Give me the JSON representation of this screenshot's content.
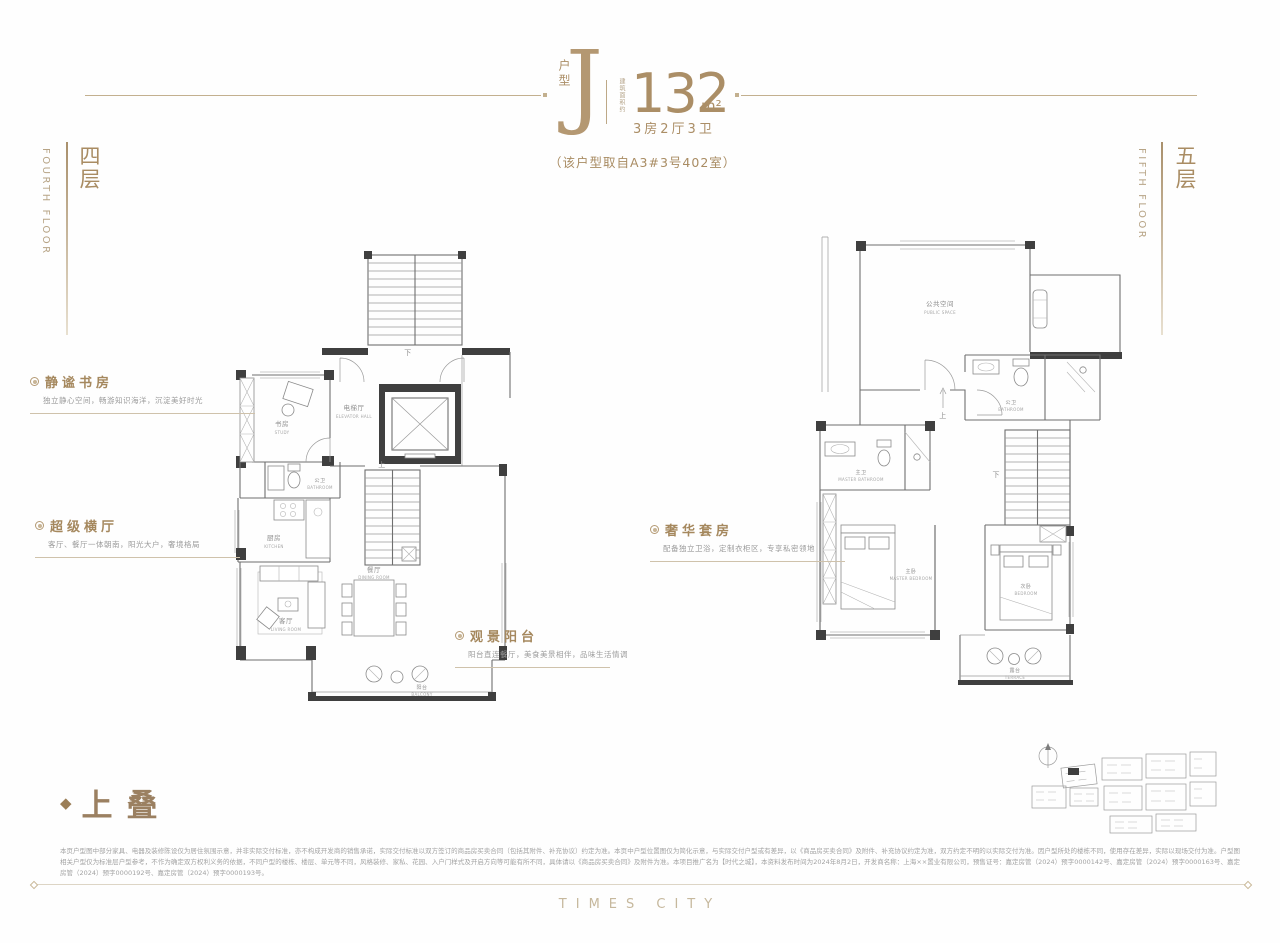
{
  "header": {
    "unit_type_label": "户型",
    "unit_type": "J",
    "area_prefix": "建筑面积约",
    "area_value": "132",
    "area_unit": "m²",
    "layout": "3房2厅3卫",
    "source_note": "（该户型取自A3#3号402室）"
  },
  "floor_left": {
    "cn": "四层",
    "en": "FOURTH FLOOR"
  },
  "floor_right": {
    "cn": "五层",
    "en": "FIFTH FLOOR"
  },
  "annotations": [
    {
      "title": "静谧书房",
      "desc": "独立静心空间，畅游知识海洋，沉淀美好时光"
    },
    {
      "title": "超级横厅",
      "desc": "客厅、餐厅一体朝南，阳光大户，奢境格局"
    },
    {
      "title": "观景阳台",
      "desc": "阳台直连餐厅，美食美景相伴，品味生活情调"
    },
    {
      "title": "奢华套房",
      "desc": "配备独立卫浴，定制衣柜区，专享私密领地"
    }
  ],
  "floor4_rooms": {
    "study_cn": "书房",
    "study_en": "STUDY",
    "elevator_cn": "电梯厅",
    "elevator_en": "ELEVATOR HALL",
    "bath_cn": "公卫",
    "bath_en": "BATHROOM",
    "kitchen_cn": "厨房",
    "kitchen_en": "KITCHEN",
    "living_cn": "客厅",
    "living_en": "LIVING ROOM",
    "dining_cn": "餐厅",
    "dining_en": "DINING ROOM",
    "balcony_cn": "阳台",
    "balcony_en": "BALCONY",
    "stair_up": "上",
    "stair_down": "下"
  },
  "floor5_rooms": {
    "public_cn": "公共空间",
    "public_en": "PUBLIC SPACE",
    "bath_cn": "公卫",
    "bath_en": "BATHROOM",
    "master_bath_cn": "主卫",
    "master_bath_en": "MASTER BATHROOM",
    "master_bed_cn": "主卧",
    "master_bed_en": "MASTER BEDROOM",
    "bed_cn": "次卧",
    "bed_en": "BEDROOM",
    "terrace_cn": "露台",
    "terrace_en": "TERRACE",
    "stair_down": "下",
    "step_up": "上"
  },
  "section_tag": {
    "marker": "◆",
    "text": "上叠"
  },
  "disclaimer": {
    "text": "本页户型图中部分家具、电器及装修陈设仅为居住氛围示意，并非实际交付标准，亦不构成开发商的销售承诺，实际交付标准以双方签订的商品房买卖合同（包括其附件、补充协议）约定为准。本页中户型位置图仅为简化示意，与实际交付户型或有差异，以《商品房买卖合同》及附件、补充协议约定为准，双方约定不明的以实际交付为准。因户型所处的楼栋不同，使用存在差异，实际以现场交付为准。户型图相关户型仅为标准层户型参考，不作为确定双方权利义务的依据，不同户型的楼栋、楼层、单元等不同，风格装修、家私、花园、入户门样式及开启方向等可能有所不同，具体请以《商品房买卖合同》及附件为准。本项目推广名为【时代之城】，本资料发布时间为2024年8月2日，开发商名称：上海××置业有限公司，预售证号：嘉定房管（2024）预字0000142号、嘉定房管（2024）预字0000163号、嘉定房管（2024）预字0000192号、嘉定房管（2024）预字0000193号。"
  },
  "logo": {
    "text": "TIMES CITY"
  },
  "colors": {
    "gold": "#ab8e66",
    "wall_dark": "#3f3f3f",
    "line_gray": "#6f6f6f",
    "label_gray": "#8f8f8f"
  }
}
